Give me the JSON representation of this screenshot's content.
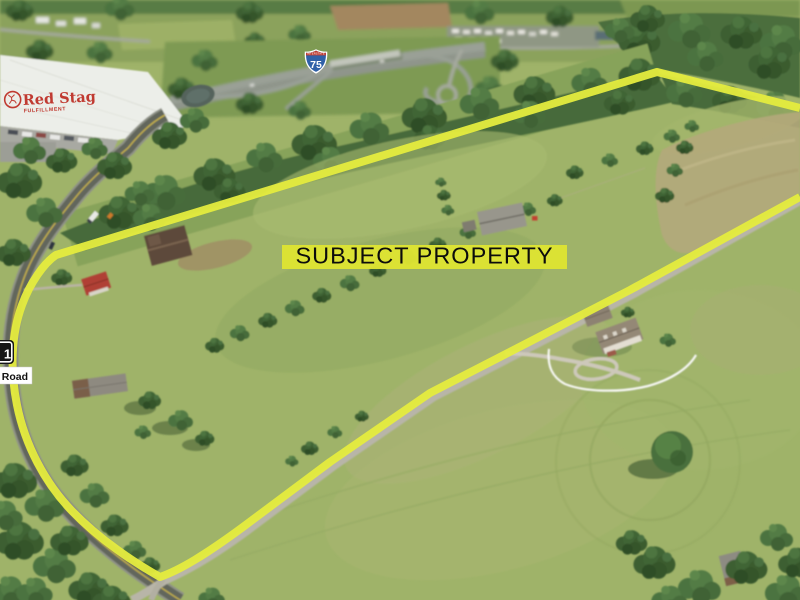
{
  "meta": {
    "alt": "Aerial drone photo of rural pastureland outlined in yellow as the subject property, with an I-75 interchange and the Red Stag Fulfillment warehouse in the background, a curving paved road on the left and a gravel road along the lower boundary"
  },
  "annotations": {
    "subject_property_label": "SUBJECT PROPERTY",
    "interstate_shield": {
      "header": "INTERSTATE",
      "number": "75"
    },
    "state_route_shield": {
      "digit": "1"
    },
    "road_name_label": "d Road",
    "red_stag_logo": {
      "name": "Red Stag",
      "subtitle": "FULFILLMENT"
    }
  },
  "colors": {
    "boundary_yellow": "#e5ec3e",
    "label_background": "#dee432",
    "label_text": "#0c0c0c",
    "red_stag_red": "#c03a31",
    "interstate_blue": "#3061a8",
    "interstate_red": "#bf3b30",
    "route_shield_black": "#161616",
    "road_label_background": "#ffffff"
  }
}
